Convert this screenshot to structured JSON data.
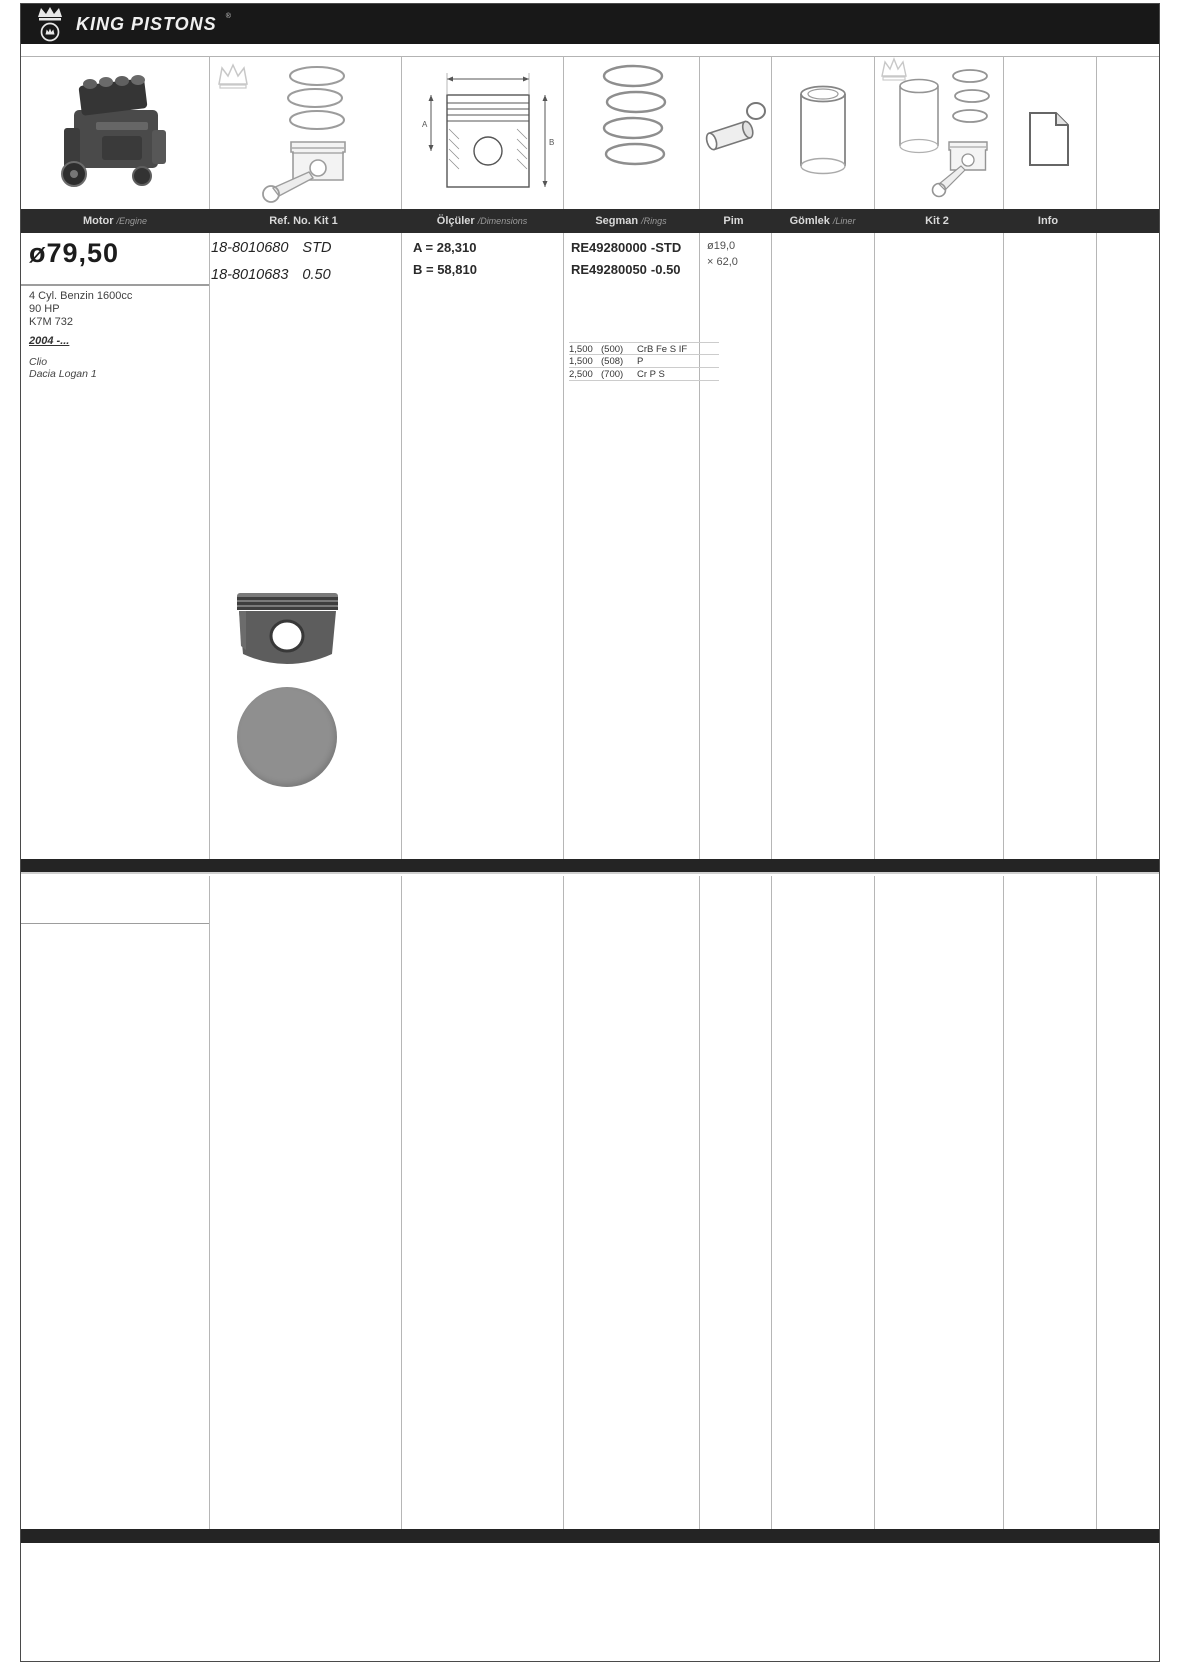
{
  "brand": {
    "name": "KING PISTONS",
    "mark": "®"
  },
  "columns": [
    {
      "label": "Motor",
      "sublabel": "/Engine"
    },
    {
      "label": "Ref. No. Kit 1",
      "sublabel": ""
    },
    {
      "label": "Ölçüler",
      "sublabel": "/Dimensions"
    },
    {
      "label": "Segman",
      "sublabel": "/Rings"
    },
    {
      "label": "Pim",
      "sublabel": ""
    },
    {
      "label": "Gömlek",
      "sublabel": "/Liner"
    },
    {
      "label": "Kit 2",
      "sublabel": ""
    },
    {
      "label": "Info",
      "sublabel": ""
    }
  ],
  "illustrations": [
    "engine-photo",
    "piston-with-connecting-rod-sketch",
    "piston-dimension-diagram",
    "piston-rings-sketch",
    "piston-pin-sketch",
    "cylinder-liner-sketch",
    "piston-kit-2-sketch",
    "info-document-icon"
  ],
  "diagram": {
    "dim_a": "A",
    "dim_b": "B"
  },
  "row1": {
    "bore": "ø79,50",
    "engine_lines": [
      "4 Cyl. Benzin 1600cc",
      "90 HP",
      "K7M 732"
    ],
    "years": "2004 -...",
    "models": [
      "Clio",
      "Dacia Logan 1"
    ],
    "ref_kit": [
      {
        "no": "18-8010680",
        "size": "STD"
      },
      {
        "no": "18-8010683",
        "size": "0.50"
      }
    ],
    "dims": [
      "A = 28,310",
      "B = 58,810"
    ],
    "ring_refs": [
      {
        "no": "RE49280000",
        "size": "-STD"
      },
      {
        "no": "RE49280050",
        "size": "-0.50"
      }
    ],
    "ring_specs": [
      {
        "height": "1,500",
        "code": "(500)",
        "type": "CrB Fe S IF"
      },
      {
        "height": "1,500",
        "code": "(508)",
        "type": "P"
      },
      {
        "height": "2,500",
        "code": "(700)",
        "type": "Cr P S"
      }
    ],
    "pin": {
      "diameter": "ø19,0",
      "length": "× 62,0"
    }
  },
  "colors": {
    "bar": "#181818",
    "header_row": "#2b2b2b",
    "piston_gray": "#8f8f8f"
  }
}
